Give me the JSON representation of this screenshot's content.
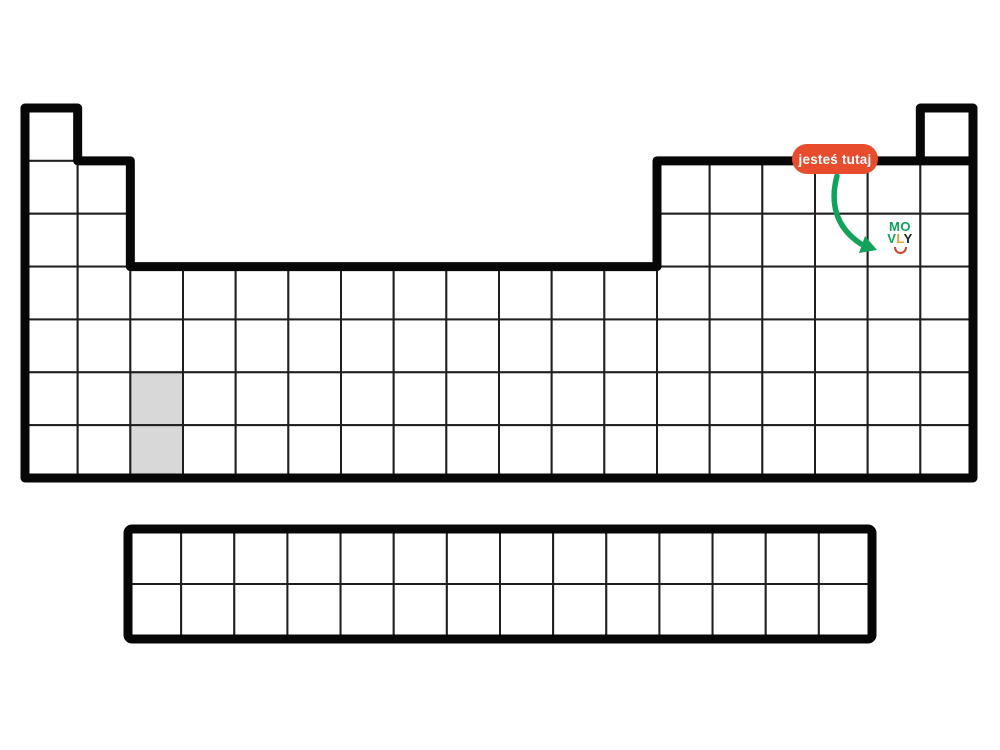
{
  "badge": {
    "label": "jesteś tutaj"
  },
  "logo": {
    "line1_letters": [
      {
        "char": "M",
        "color": "#11a35a"
      },
      {
        "char": "O",
        "color": "#11a35a"
      }
    ],
    "line2_letters": [
      {
        "char": "V",
        "color": "#11a35a"
      },
      {
        "char": "L",
        "color": "#e2a43c"
      },
      {
        "char": "Y",
        "color": "#222222"
      }
    ]
  },
  "colors": {
    "background": "#ffffff",
    "cell_fill": "#ffffff",
    "highlight_fill": "#d8d8d8",
    "grid_line": "#1f1f1f",
    "thick_border": "#070707",
    "badge_bg": "#e74c2c",
    "badge_text": "#ffffff",
    "arrow": "#11a35a",
    "logo_smile": "#d6452c"
  },
  "periodic_table": {
    "main_block": {
      "columns": 18,
      "rows": 7,
      "row_column_ranges": [
        [
          [
            1,
            1
          ],
          [
            18,
            18
          ]
        ],
        [
          [
            1,
            2
          ],
          [
            13,
            18
          ]
        ],
        [
          [
            1,
            2
          ],
          [
            13,
            18
          ]
        ],
        [
          [
            1,
            18
          ]
        ],
        [
          [
            1,
            18
          ]
        ],
        [
          [
            1,
            18
          ]
        ],
        [
          [
            1,
            18
          ]
        ]
      ],
      "highlighted_cells": [
        {
          "row": 6,
          "col": 3
        },
        {
          "row": 7,
          "col": 3
        }
      ],
      "marker_cell": {
        "row": 3,
        "col": 17
      }
    },
    "f_block": {
      "columns": 14,
      "rows": 2
    }
  }
}
